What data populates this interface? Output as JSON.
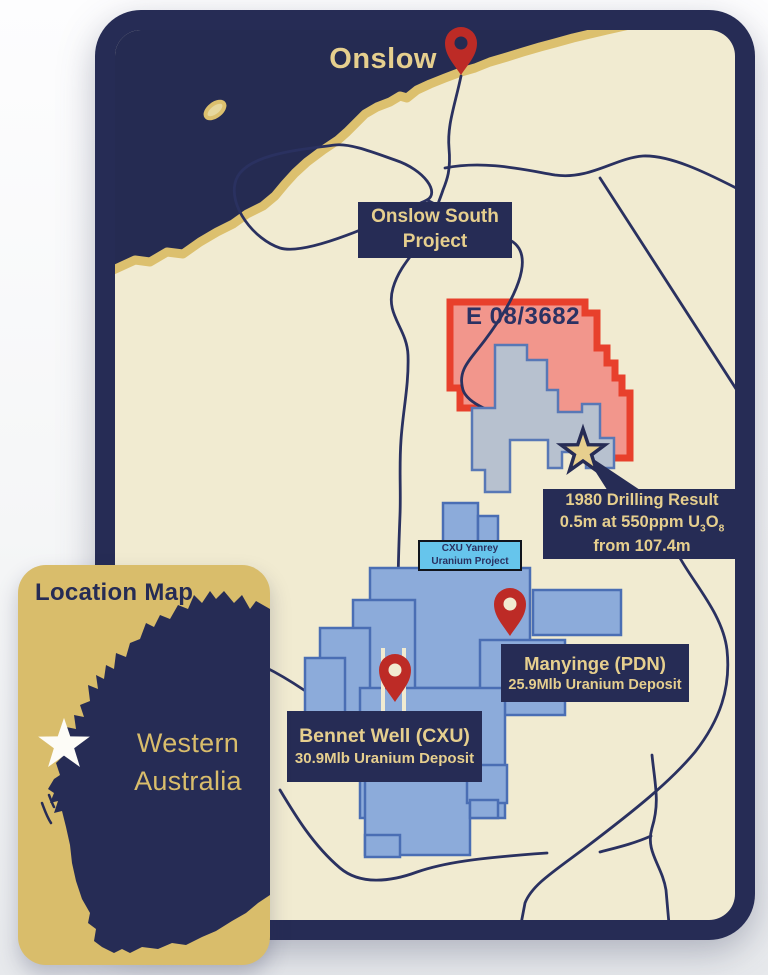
{
  "colors": {
    "navy": "#262c55",
    "ocean": "#252b52",
    "gold_text": "#e6cf8e",
    "coast_gold": "#dcc06e",
    "land": "#f1ebd1",
    "red_stroke": "#e8402c",
    "red_fill": "#f2968c",
    "blue_fill": "#8cabda",
    "blue_stroke": "#4a6eb4",
    "grey_fill": "#b7c1cf",
    "grey_stroke": "#5878b6",
    "yanrey_bg": "#66c5ec",
    "inset_bg": "#d9bd6b",
    "pin_red": "#bd2b26",
    "star_gold": "#e7cf8e",
    "road": "#2a3160"
  },
  "map": {
    "town_label": "Onslow",
    "project_box": {
      "line1": "Onslow South",
      "line2": "Project"
    },
    "tenement_id": "E 08/3682",
    "drilling_box": {
      "line1": "1980 Drilling Result",
      "line2_prefix": "0.5m at 550ppm U",
      "line2_sub_a": "3",
      "line2_mid": "O",
      "line2_sub_b": "8",
      "line3": "from 107.4m"
    },
    "yanrey_box": {
      "line1": "CXU Yanrey",
      "line2": "Uranium Project"
    },
    "manyinge_box": {
      "line1": "Manyinge (PDN)",
      "line2": "25.9Mlb Uranium Deposit"
    },
    "bennet_box": {
      "line1": "Bennet Well (CXU)",
      "line2": "30.9Mlb Uranium Deposit"
    }
  },
  "inset": {
    "title": "Location Map",
    "state_line1": "Western",
    "state_line2": "Australia"
  }
}
